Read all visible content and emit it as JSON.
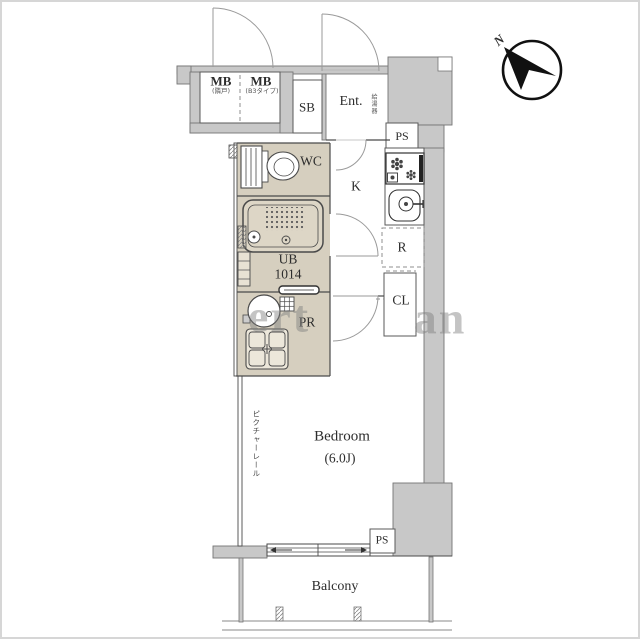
{
  "labels": {
    "mb1": "MB",
    "mb1_sub": "(隣戸)",
    "mb2": "MB",
    "mb2_sub": "(B3タイプ)",
    "sb": "SB",
    "ent": "Ent.",
    "water_heater": "給湯器",
    "ps_top": "PS",
    "wc": "WC",
    "k": "K",
    "ub": "UB",
    "ub_size": "1014",
    "r": "R",
    "pr": "PR",
    "cl": "CL",
    "bedroom": "Bedroom",
    "bedroom_size": "(6.0J)",
    "picture_rail": "ピクチャーレール",
    "ps_bottom": "PS",
    "balcony": "Balcony",
    "north": "N"
  },
  "watermark": {
    "left": "ert",
    "right": "an"
  },
  "colors": {
    "wall_fill": "#c8c8c8",
    "wall_outline": "#757575",
    "wet_room_fill": "#d6cfbf",
    "line": "#4a4a4a",
    "door_arc": "#9a9a9a"
  }
}
